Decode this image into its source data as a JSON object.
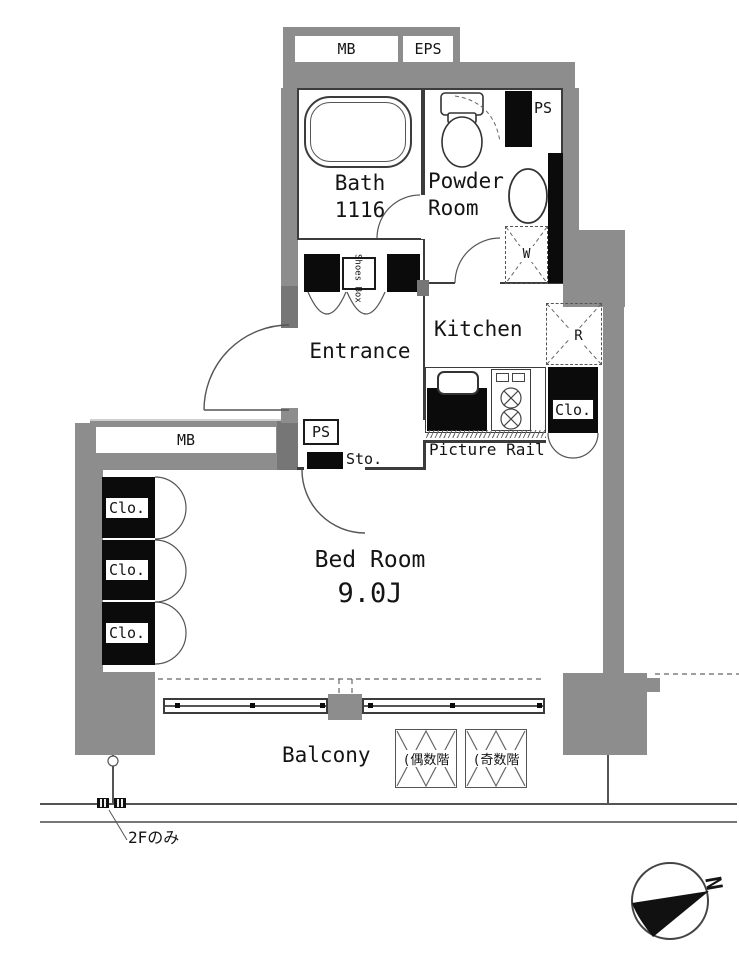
{
  "plan": {
    "top_unit": {
      "mb": "MB",
      "eps": "EPS"
    },
    "utilities": {
      "ps_top": "PS",
      "ps_left": "PS",
      "sto": "Sto.",
      "mb_left": "MB",
      "shoes_box": "Shoes Box",
      "washer": "W",
      "fridge": "R"
    },
    "rooms": {
      "bath": {
        "name": "Bath",
        "size": "1116"
      },
      "powder": {
        "line1": "Powder",
        "line2": "Room"
      },
      "entrance": "Entrance",
      "kitchen": "Kitchen",
      "bedroom": {
        "name": "Bed Room",
        "size": "9.0J"
      },
      "balcony": "Balcony"
    },
    "closets": {
      "kitchen": "Clo.",
      "left": [
        "Clo.",
        "Clo.",
        "Clo."
      ]
    },
    "labels": {
      "picture_rail": "Picture Rail",
      "hatch_even": "(偶数階",
      "hatch_odd": "(奇数階",
      "floor_note": "2Fのみ",
      "compass_north": "N"
    }
  },
  "colors": {
    "wall": "#8d8d8d",
    "wall_dark": "#767676",
    "fixture_black": "#0b0b0b",
    "line": "#3c3c3c",
    "background": "#ffffff"
  }
}
